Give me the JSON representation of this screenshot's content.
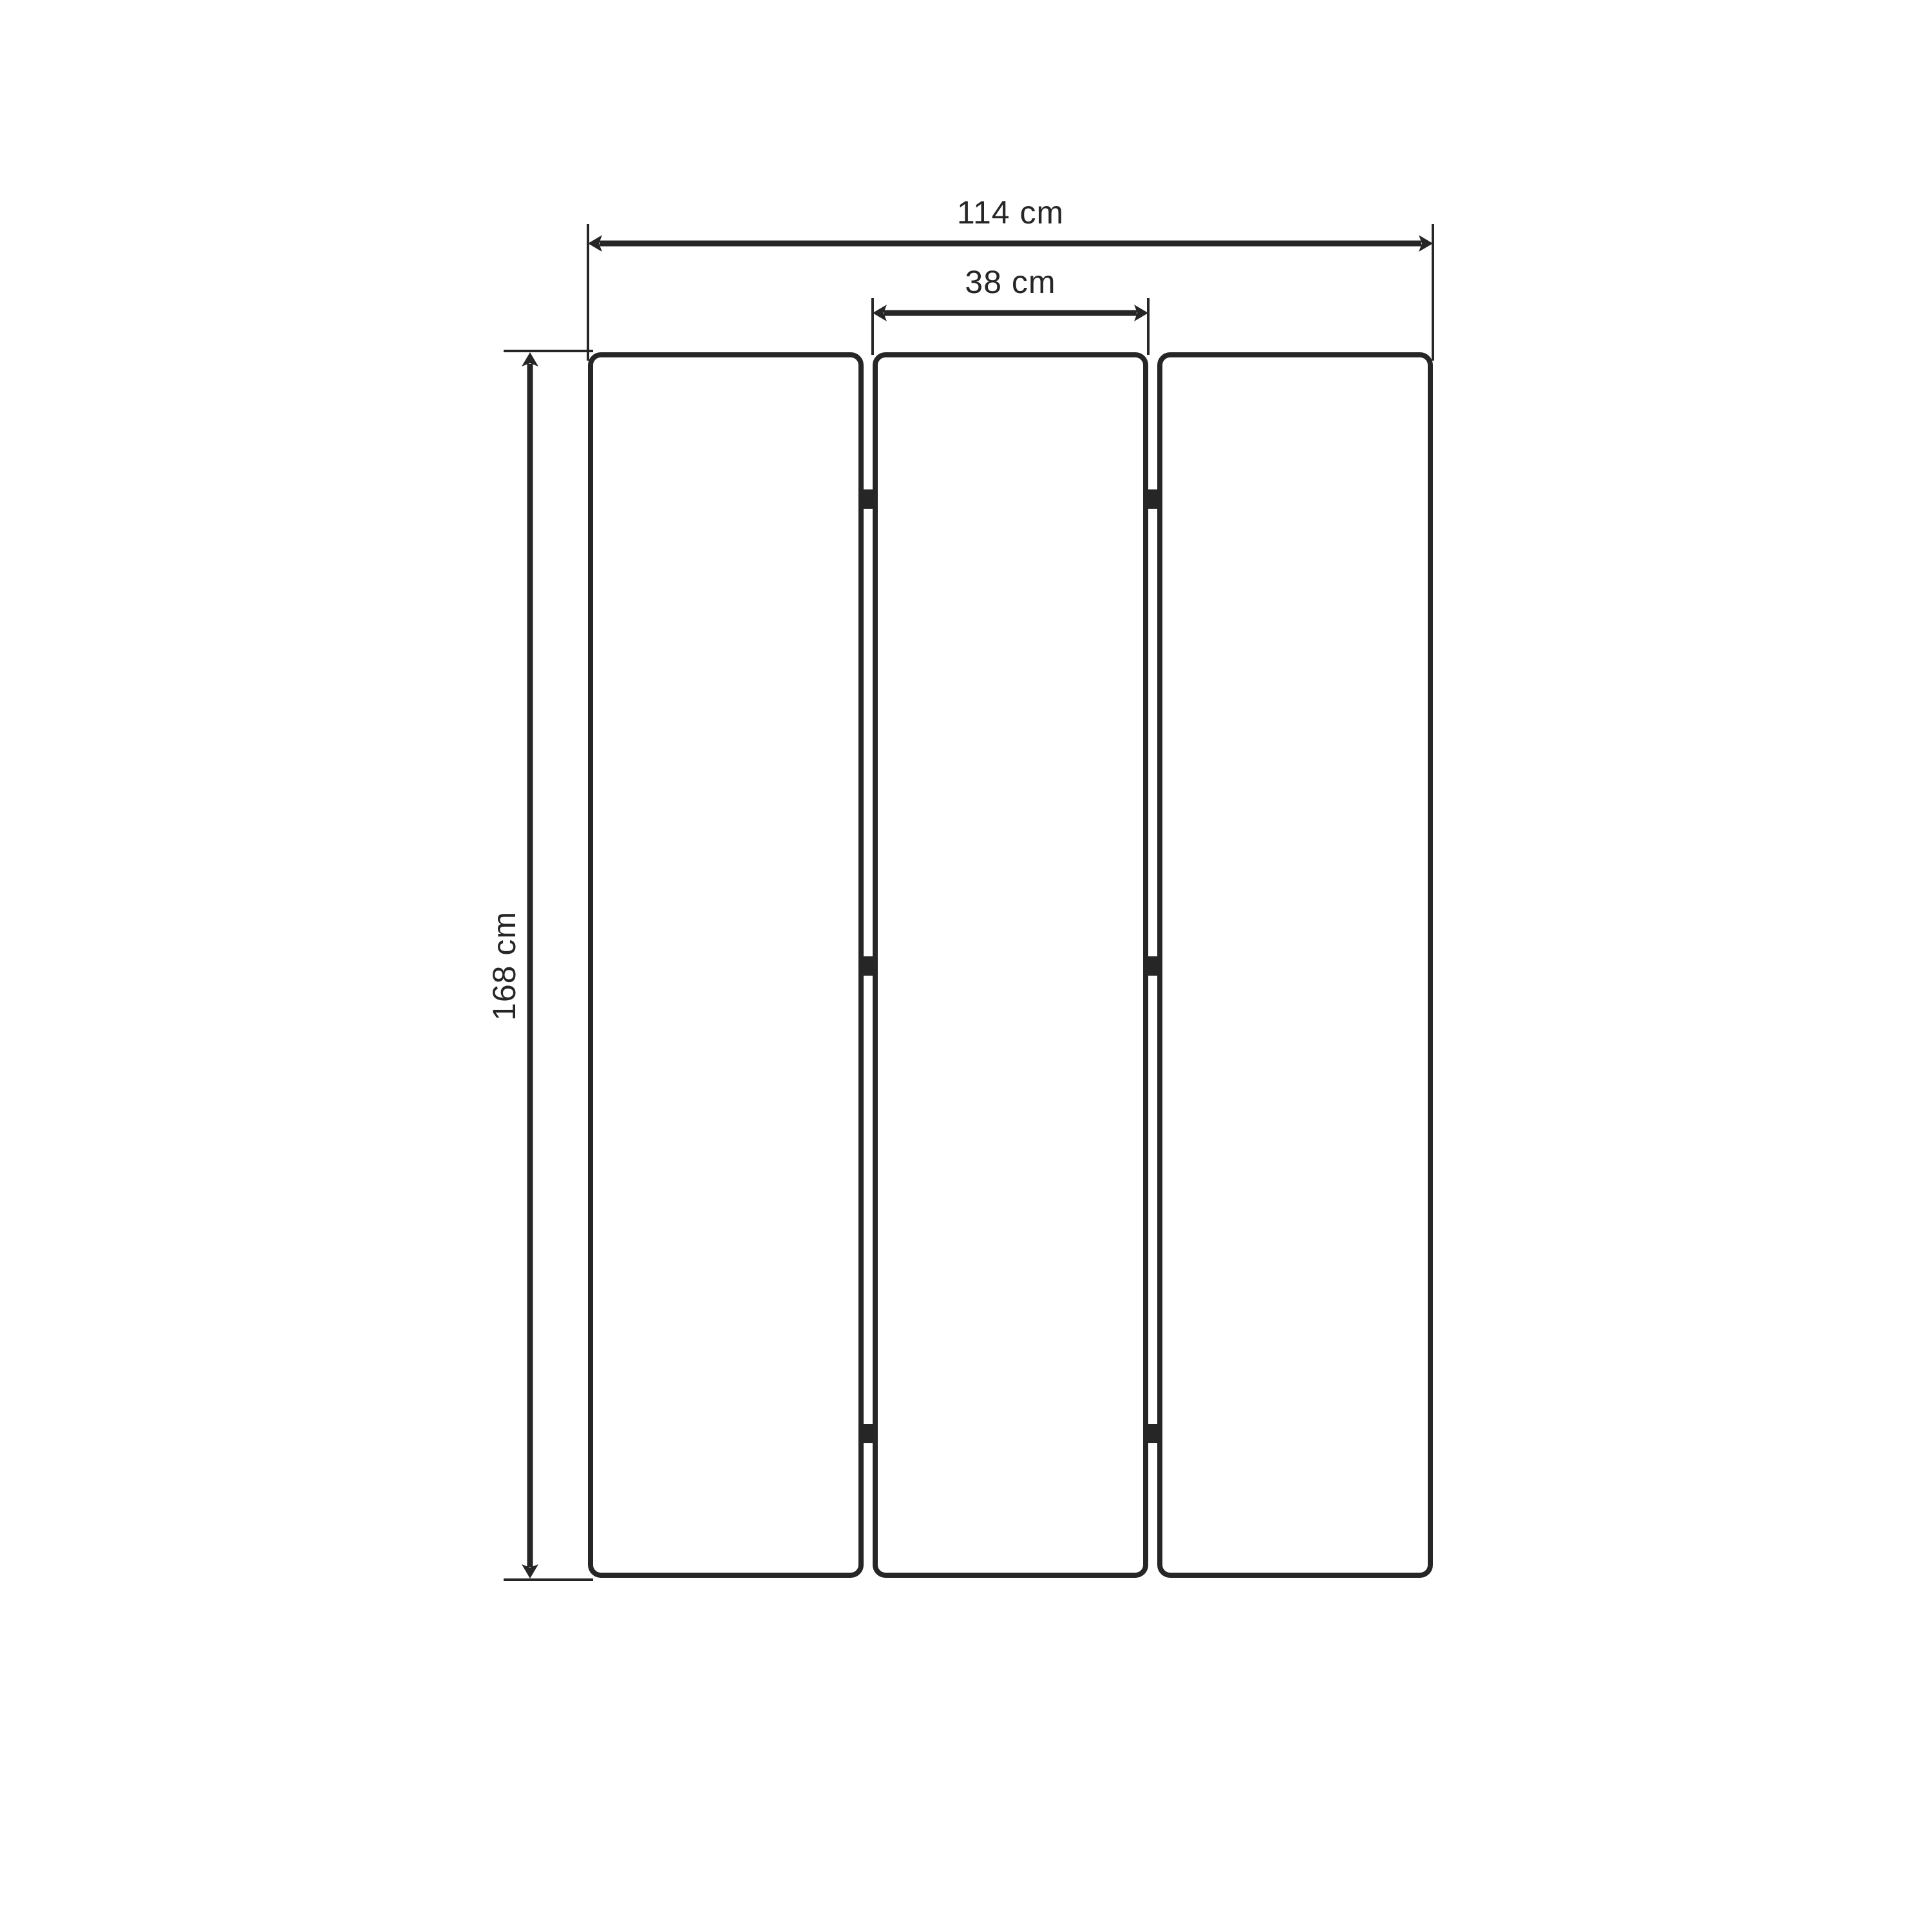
{
  "drawing": {
    "subject": "three-panel folding screen, front elevation",
    "background_color": "#ffffff",
    "line_color": "#262626",
    "panels": {
      "count": 3,
      "hinges_per_gap": 3
    },
    "dimensions": {
      "total_width": {
        "value": 114,
        "unit": "cm",
        "label": "114 cm"
      },
      "panel_width": {
        "value": 38,
        "unit": "cm",
        "label": "38 cm"
      },
      "height": {
        "value": 168,
        "unit": "cm",
        "label": "168 cm"
      }
    }
  }
}
